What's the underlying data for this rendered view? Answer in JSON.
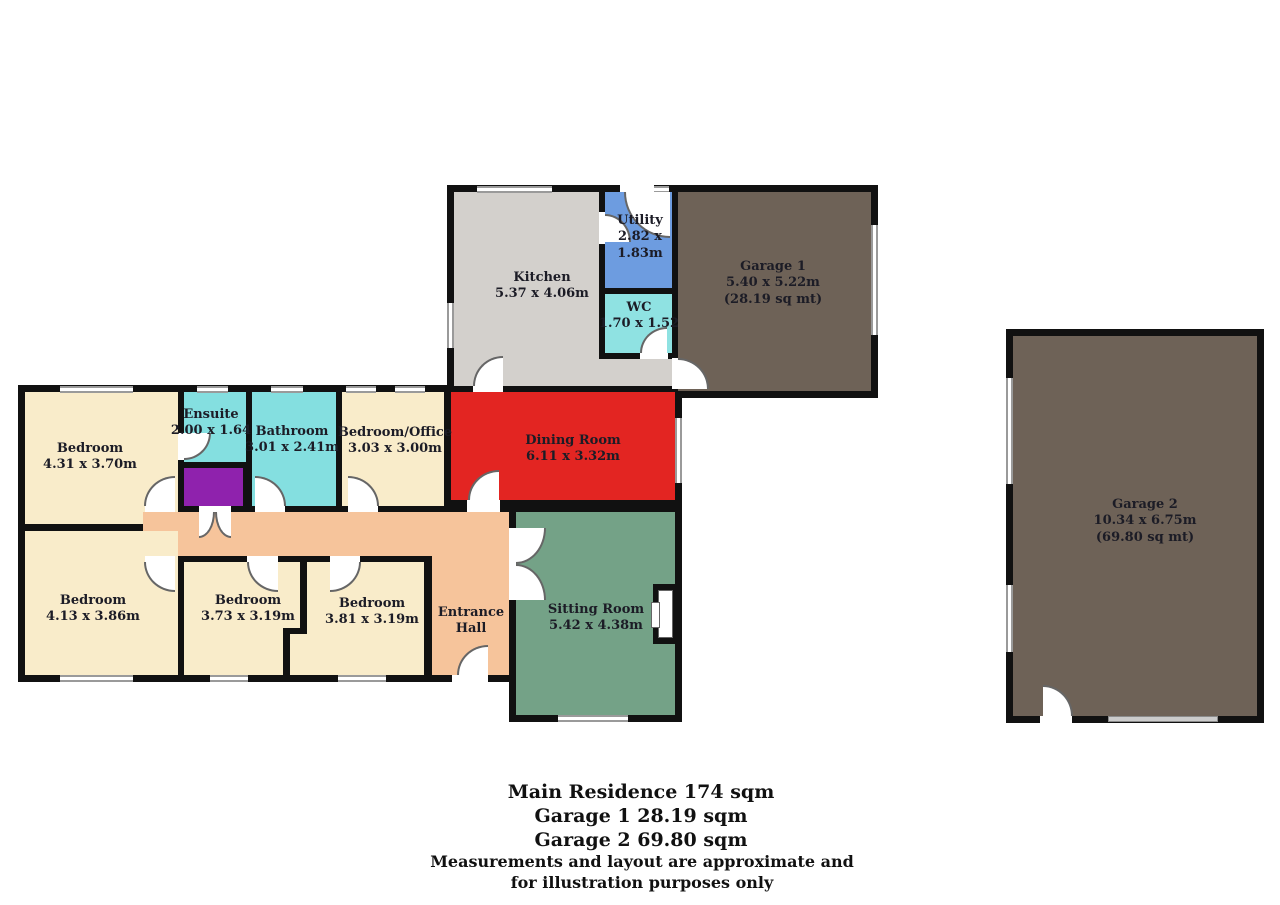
{
  "title": "Residential floor plan",
  "rooms": {
    "kitchen": {
      "label": "Kitchen",
      "dims": "5.37 x 4.06m"
    },
    "utility": {
      "label": "Utility",
      "dims_a": "2.82 x",
      "dims_b": "1.83m"
    },
    "wc": {
      "label": "WC",
      "dims": "1.70 x 1.52"
    },
    "garage1": {
      "label": "Garage 1",
      "dims": "5.40 x 5.22m",
      "area": "(28.19 sq mt)"
    },
    "dining": {
      "label": "Dining Room",
      "dims": "6.11 x 3.32m"
    },
    "bedroom1": {
      "label": "Bedroom",
      "dims": "4.31 x 3.70m"
    },
    "ensuite": {
      "label": "Ensuite",
      "dims": "2.00 x 1.64"
    },
    "bathroom": {
      "label": "Bathroom",
      "dims": "3.01 x 2.41m"
    },
    "office": {
      "label": "Bedroom/Office",
      "dims": "3.03 x 3.00m"
    },
    "bedroom2": {
      "label": "Bedroom",
      "dims": "4.13 x 3.86m"
    },
    "bedroom3": {
      "label": "Bedroom",
      "dims": "3.73 x 3.19m"
    },
    "bedroom4": {
      "label": "Bedroom",
      "dims": "3.81 x 3.19m"
    },
    "hall": {
      "label_a": "Entrance",
      "label_b": "Hall"
    },
    "sitting": {
      "label": "Sitting Room",
      "dims": "5.42 x 4.38m"
    },
    "garage2": {
      "label": "Garage 2",
      "dims": "10.34 x 6.75m",
      "area": "(69.80 sq mt)"
    }
  },
  "colors": {
    "wall": "#111111",
    "kitchen": "#d3d0cc",
    "utility": "#6d9ce0",
    "wc": "#8fe2e2",
    "garage": "#6e6257",
    "dining": "#e32522",
    "sitting": "#74a287",
    "bedroom": "#f9ecca",
    "hallway": "#f6c49b",
    "bathroom": "#84dfe0",
    "ensuite": "#84dfe0",
    "cupboard": "#8f22ad"
  },
  "footer": {
    "main_residence": "Main Residence 174 sqm",
    "garage_1": "Garage 1 28.19 sqm",
    "garage_2": "Garage 2 69.80 sqm",
    "disclaimer_line_1": "Measurements and layout are approximate and",
    "disclaimer_line_2": "for illustration purposes only"
  }
}
